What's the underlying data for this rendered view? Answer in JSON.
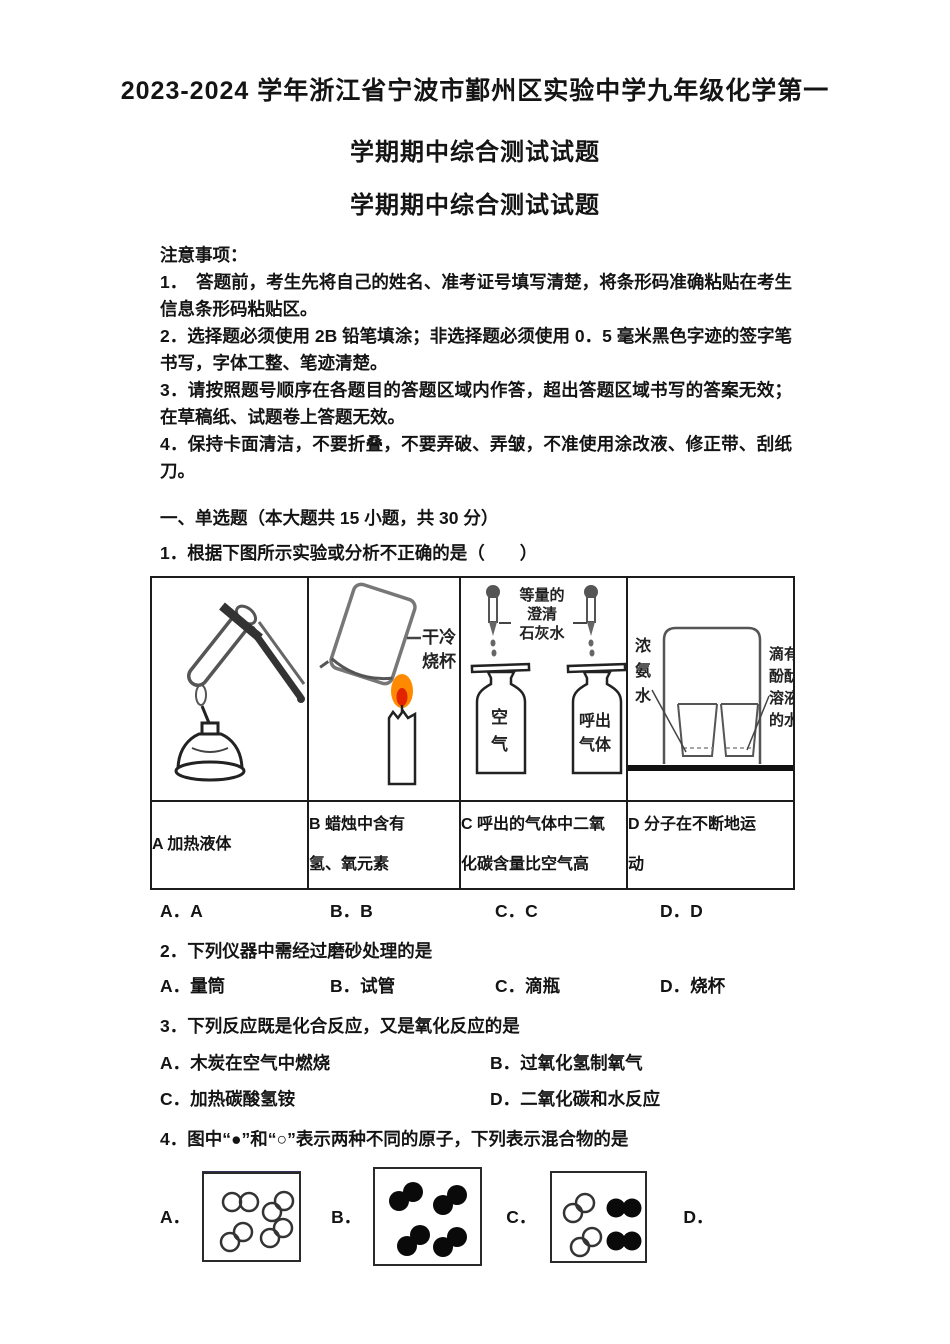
{
  "title": {
    "line1": "2023-2024 学年浙江省宁波市鄞州区实验中学九年级化学第一",
    "line2": "学期期中综合测试试题",
    "line3": "学期期中综合测试试题"
  },
  "notes": {
    "heading": "注意事项：",
    "items": [
      "1．　答题前，考生先将自己的姓名、准考证号填写清楚，将条形码准确粘贴在考生信息条形码粘贴区。",
      "2．选择题必须使用 2B 铅笔填涂；非选择题必须使用 0．5 毫米黑色字迹的签字笔书写，字体工整、笔迹清楚。",
      "3．请按照题号顺序在各题目的答题区域内作答，超出答题区域书写的答案无效；在草稿纸、试题卷上答题无效。",
      "4．保持卡面清洁，不要折叠，不要弄破、弄皱，不准使用涂改液、修正带、刮纸刀。"
    ]
  },
  "section1": {
    "heading": "一、单选题（本大题共 15 小题，共 30 分）"
  },
  "q1": {
    "text": "1．根据下图所示实验或分析不正确的是（　　）",
    "figures": {
      "b_beaker_label": "干冷\n烧杯",
      "c_center_label": "等量的\n澄清\n石灰水",
      "c_bottle_left": "空\n气",
      "c_bottle_right": "呼出\n气体",
      "d_left_label": "浓\n氨\n水",
      "d_right_label": "滴有\n酚酞\n溶液\n的水"
    },
    "captions": [
      "A 加热液体",
      "B 蜡烛中含有\n氢、氧元素",
      "C 呼出的气体中二氧\n化碳含量比空气高",
      "D 分子在不断地运\n动"
    ],
    "options": [
      "A．A",
      "B．B",
      "C．C",
      "D．D"
    ]
  },
  "q2": {
    "text": "2．下列仪器中需经过磨砂处理的是",
    "options": [
      "A．量筒",
      "B．试管",
      "C．滴瓶",
      "D．烧杯"
    ]
  },
  "q3": {
    "text": "3．下列反应既是化合反应，又是氧化反应的是",
    "options": [
      "A．木炭在空气中燃烧",
      "B．过氧化氢制氧气",
      "C．加热碳酸氢铵",
      "D．二氧化碳和水反应"
    ]
  },
  "q4": {
    "text": "4．图中“●”和“○”表示两种不同的原子，下列表示混合物的是",
    "option_labels": [
      "A．",
      "B．",
      "C．",
      "D．"
    ]
  },
  "colors": {
    "flame_outer": "#ff8a00",
    "flame_inner": "#e32400",
    "ink": "#141414"
  }
}
